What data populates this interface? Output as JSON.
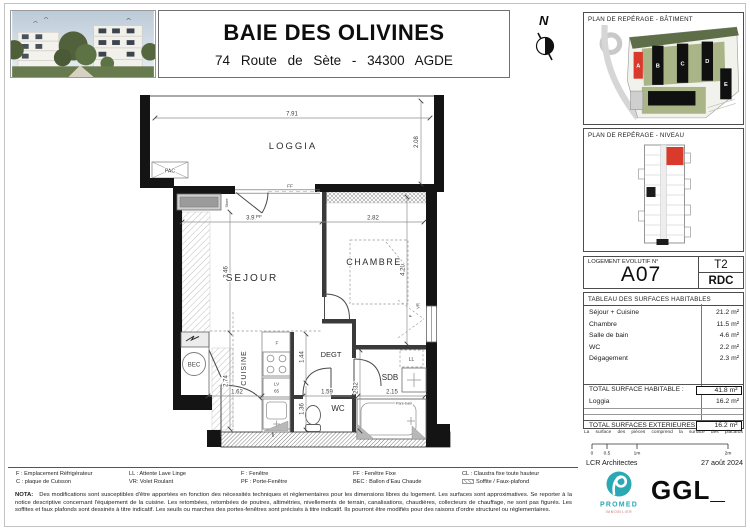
{
  "header": {
    "title": "BAIE DES OLIVINES",
    "address": "74 Route de Sète - 34300 AGDE",
    "north": "N"
  },
  "plan": {
    "rooms": {
      "loggia": "LOGGIA",
      "sejour": "SEJOUR",
      "chambre": "CHAMBRE",
      "cuisine": "CUISINE",
      "degt": "DEGT",
      "wc": "WC",
      "sdb": "SDB"
    },
    "equipment": {
      "pac": "PAC",
      "bec": "BEC",
      "store": "Store",
      "lv": "LV",
      "lv_width": "65",
      "ll": "LL",
      "fridge": "F",
      "pare_bain": "Pare-bain",
      "window": "F",
      "shutter": "VR",
      "door_window": "PF",
      "fixed_window": "FF"
    },
    "dims": {
      "loggia_width": "7.91",
      "loggia_depth": "2.08",
      "sejour_width": "3.97",
      "chambre_width": "2.82",
      "sejour_depth": "3.46",
      "chambre_depth": "4.20",
      "cuisine_depth": "2.74",
      "cuisine_width": "1.62",
      "degt_depth": "1.44",
      "degt_width": "1.59",
      "wc_depth": "1.36",
      "sdb_depth": "2.32",
      "sdb_width": "2.15"
    }
  },
  "sidebar": {
    "batiment": {
      "title": "PLAN DE REPÉRAGE - BÂTIMENT",
      "buildings": [
        "A",
        "B",
        "C",
        "D",
        "E"
      ]
    },
    "niveau": {
      "title": "PLAN DE REPÉRAGE - NIVEAU"
    },
    "unit": {
      "label": "LOGEMENT EVOLUTIF N°",
      "number": "A07",
      "type": "T2",
      "floor": "RDC"
    },
    "surfaces": {
      "title": "TABLEAU DES SURFACES HABITABLES",
      "rows": [
        {
          "label": "Séjour + Cuisine",
          "value": "21.2 m²"
        },
        {
          "label": "Chambre",
          "value": "11.5 m²"
        },
        {
          "label": "Salle de bain",
          "value": "4.6 m²"
        },
        {
          "label": "WC",
          "value": "2.2 m²"
        },
        {
          "label": "Dégagement",
          "value": "2.3 m²"
        }
      ],
      "total_label": "TOTAL SURFACE HABITABLE :",
      "total_value": "41.8 m²",
      "loggia_label": "Loggia",
      "loggia_value": "16.2 m²",
      "exterior_label": "TOTAL SURFACES EXTERIEURES :",
      "exterior_value": "16.2 m²",
      "note": "La surface des pièces comprend la surface des placards"
    },
    "scale_bar": {
      "ticks": [
        "0",
        "0.5",
        "1m",
        "2m"
      ]
    },
    "credits": {
      "architect": "LCR Architectes",
      "date": "27 août 2024"
    },
    "logos": {
      "promed": "PROMED",
      "promed_sub": "IMMOBILIER",
      "ggl": "GGL_"
    }
  },
  "legend": {
    "items": [
      "F : Emplacement Réfrigérateur",
      "C : plaque de Cuisson",
      "LL : Attente Lave Linge",
      "VR: Volet Roulant",
      "F : Fenêtre",
      "PF : Porte-Fenêtre",
      "FF : Fenêtre Fixe",
      "BEC : Ballon d'Eau Chaude",
      "CL : Claustra fixe toute hauteur",
      "Soffite / Faux-plafond"
    ]
  },
  "nota": {
    "heading": "NOTA:",
    "text": "Des modifications sont susceptibles d'être apportées en fonction des nécessités techniques et réglementaires pour les dimensions libres du logement. Les surfaces sont approximatives. Se reporter à la notice descriptive concernant l'équipement de la cuisine. Les retombées, retombées de poutres, altimétries, nivellements de terrain, canalisations, chaudières, collecteurs de chauffage, ne sont pas figurés. Les soffites et faux plafonds sont dessinés à titre indicatif. Les seuils ou marches des portes-fenêtres sont précisés à titre indicatif. Ils pourront être modifiés pour des raisons d'ordre structurel ou réglementaires."
  },
  "colors": {
    "accent_red": "#d93a2b",
    "promed_teal": "#29a8b5",
    "site_green": "#a9b587"
  }
}
